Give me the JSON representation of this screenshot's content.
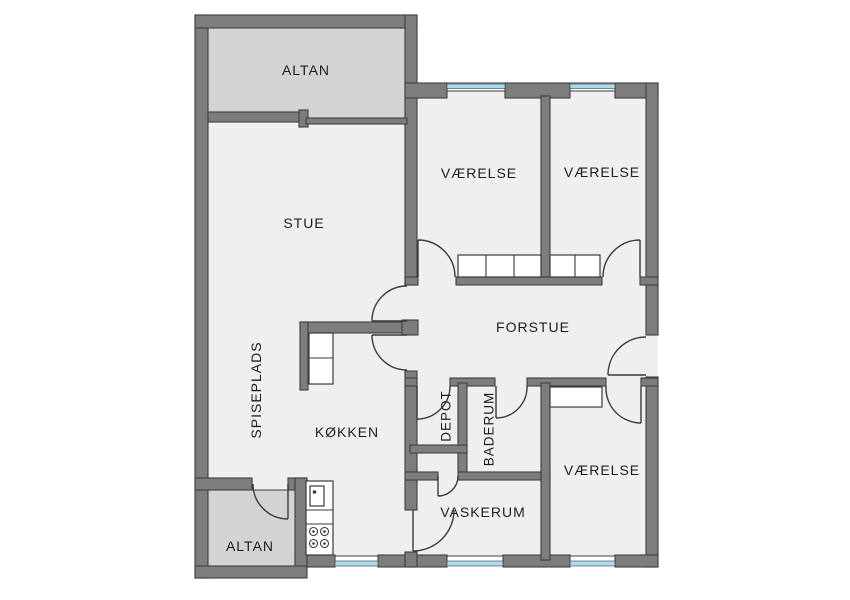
{
  "plan_title": "Apartment floor plan",
  "colors": {
    "page_bg": "#ffffff",
    "wall": "#7d7d7d",
    "wall_stroke": "#3e3e3e",
    "floor": "#efefef",
    "balcony": "#d3d3d3",
    "glass": "#a6ddef",
    "fixture": "#3a3a3a",
    "label": "#1d1d1d"
  },
  "labels": {
    "altan_top": "ALTAN",
    "stue": "STUE",
    "vaerelse_nw": "VÆRELSE",
    "vaerelse_ne": "VÆRELSE",
    "forstue": "FORSTUE",
    "spiseplads": "SPISEPLADS",
    "koekken": "KØKKEN",
    "depot": "DEPOT",
    "baderum": "BADERUM",
    "vaskerum": "VASKERUM",
    "vaerelse_se": "VÆRELSE",
    "altan_bottom": "ALTAN"
  }
}
